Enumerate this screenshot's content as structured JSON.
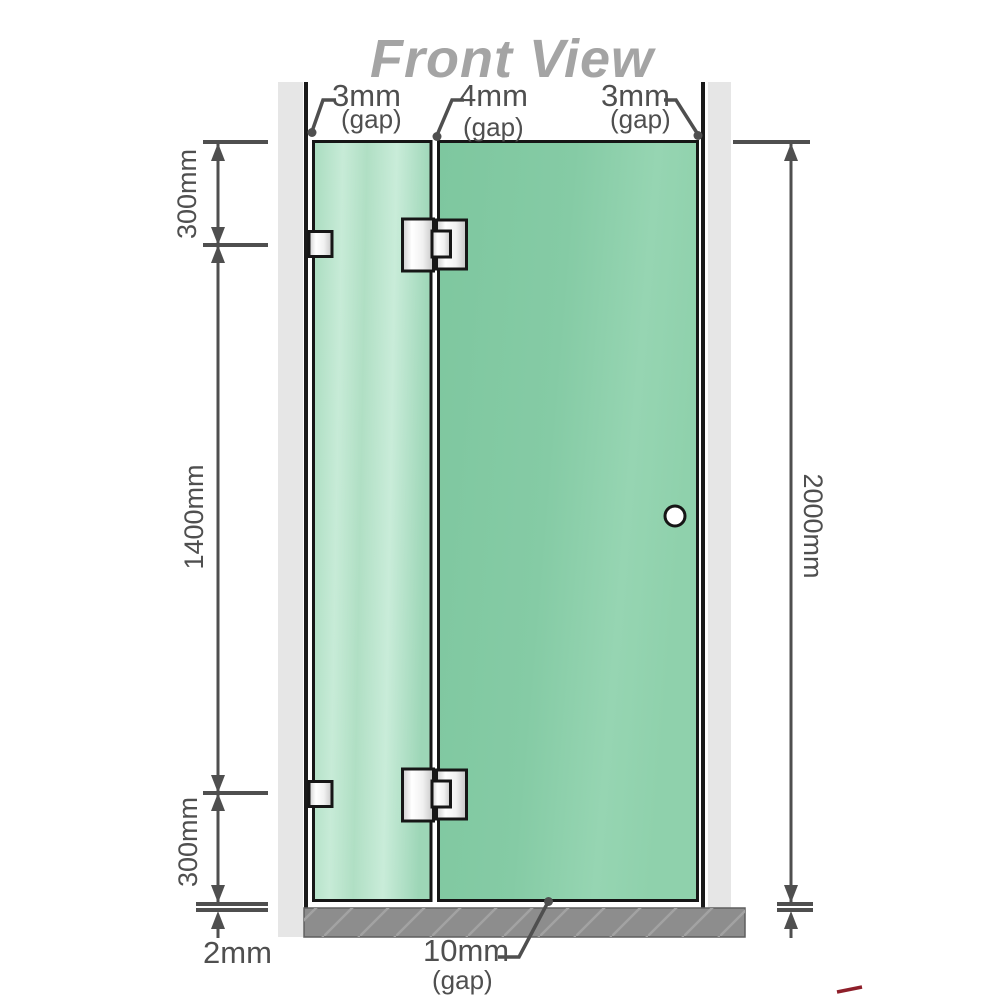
{
  "title": "Front View",
  "dimensions": {
    "top_left_gap": {
      "value": "3mm",
      "suffix": "(gap)"
    },
    "top_middle_gap": {
      "value": "4mm",
      "suffix": "(gap)"
    },
    "top_right_gap": {
      "value": "3mm",
      "suffix": "(gap)"
    },
    "bottom_middle_gap": {
      "value": "10mm",
      "suffix": "(gap)"
    },
    "left_upper": "300mm",
    "left_middle": "1400mm",
    "left_lower": "300mm",
    "bottom_left": "2mm",
    "right_full": "2000mm"
  },
  "colors": {
    "glass_green": "#85cba6",
    "glass_green_light": "#b5e1c8",
    "wall_gray": "#e6e6e6",
    "wall_edge_black": "#1a1a1a",
    "floor_gray": "#8d8d8d",
    "floor_hatch": "#a2a2a2",
    "dimension_gray": "#4f4f4f",
    "title_gray": "#a4a4a4",
    "hardware_silver": "#ededed",
    "accent_red": "#8e1f2a"
  }
}
